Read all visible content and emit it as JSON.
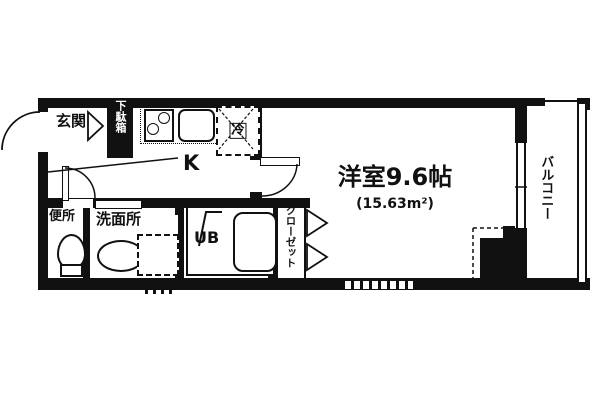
{
  "floorplan": {
    "type": "apartment-floor-plan",
    "wall_color": "#111111",
    "background_color": "#ffffff",
    "labels": {
      "entrance": "玄関",
      "shoe_cabinet": "下駄箱",
      "fridge": "冷",
      "kitchen": "K",
      "main_room": "洋室9.6帖",
      "main_room_area": "(15.63m²)",
      "balcony": "バルコニー",
      "toilet": "便所",
      "washroom": "洗面所",
      "unit_bath": "UB",
      "closet": "クローゼット"
    }
  }
}
